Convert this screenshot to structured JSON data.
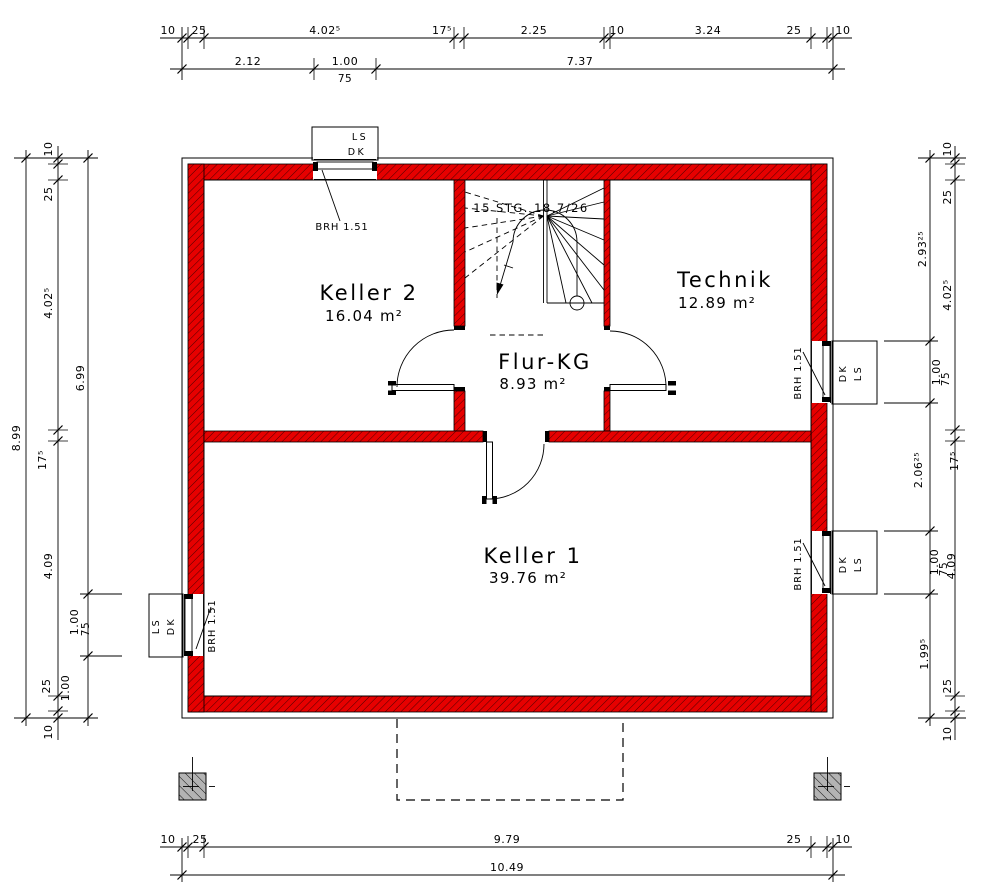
{
  "rooms": [
    {
      "name": "Keller 2",
      "area": "16.04 m²"
    },
    {
      "name": "Technik",
      "area": "12.89 m²"
    },
    {
      "name": "Flur-KG",
      "area": "8.93 m²"
    },
    {
      "name": "Keller 1",
      "area": "39.76 m²"
    }
  ],
  "stair": {
    "label": "15 STG. 18,7/26"
  },
  "windows": {
    "ls": "LS",
    "dk": "DK",
    "brh": "BRH 1.51"
  },
  "dims": {
    "top1": [
      "10",
      "25",
      "4.02⁵",
      "17⁵",
      "2.25",
      "10",
      "3.24",
      "25",
      "10"
    ],
    "top2": [
      "2.12",
      "1.00",
      "7.37"
    ],
    "top2_sub": "75",
    "bottom1": [
      "10",
      "25",
      "9.79",
      "25",
      "10"
    ],
    "bottom_total": "10.49",
    "left_outer": "8.99",
    "left_mid": [
      "10",
      "25",
      "4.02⁵",
      "17⁵",
      "4.09",
      "25",
      "10"
    ],
    "left_inner": [
      "6.99",
      "1.00",
      "1.00"
    ],
    "left_inner_sub": "75",
    "right_inner": [
      "2.93²⁵",
      "1.00",
      "2.06²⁵",
      "1.00",
      "1.99⁵"
    ],
    "right_inner_sub1": "75",
    "right_inner_sub2": "75",
    "right_outer": [
      "10",
      "25",
      "4.02⁵",
      "17⁵",
      "4.09",
      "25",
      "10"
    ]
  },
  "colors": {
    "wall": "#e60000",
    "column": "#b3b3b3",
    "line": "#000000"
  }
}
